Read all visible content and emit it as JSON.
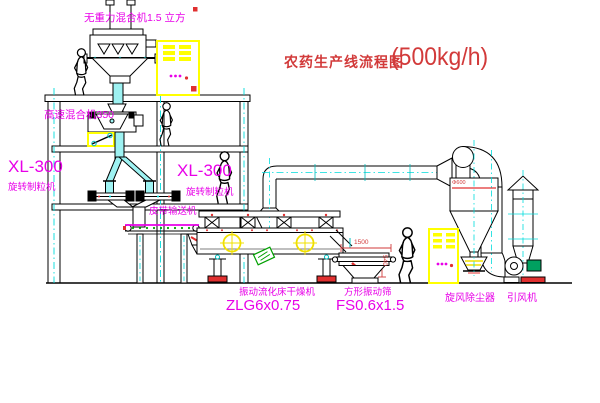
{
  "title": {
    "main": "农药生产线流程图",
    "capacity": "(500kg/h)"
  },
  "labels": {
    "gravity_mixer": "无重力混合机1.5 立方",
    "high_speed_mixer": "高速混合机350",
    "granulator_left_model": "XL-300",
    "granulator_left_name": "旋转制粒机",
    "granulator_right_model": "XL-300",
    "granulator_right_name": "旋转制粒机",
    "belt_conveyor": "皮带输送机",
    "dryer_name": "振动流化床干燥机",
    "dryer_model": "ZLG6x0.75",
    "screen_name": "方形振动筛",
    "screen_model": "FS0.6x1.5",
    "cyclone": "旋风除尘器",
    "fan": "引风机"
  },
  "dimensions": {
    "screen_length": "1500",
    "screen_height": "540",
    "cyclone_diameter": "Φ600"
  },
  "colors": {
    "label_magenta": "#e800e8",
    "title_red": "#cc3939",
    "accent_red": "#ff2a2a",
    "centerline_cyan": "#00dcdc",
    "cabinet_yellow": "#ffff00",
    "accent_green": "#00a000",
    "line_black": "#000000"
  }
}
